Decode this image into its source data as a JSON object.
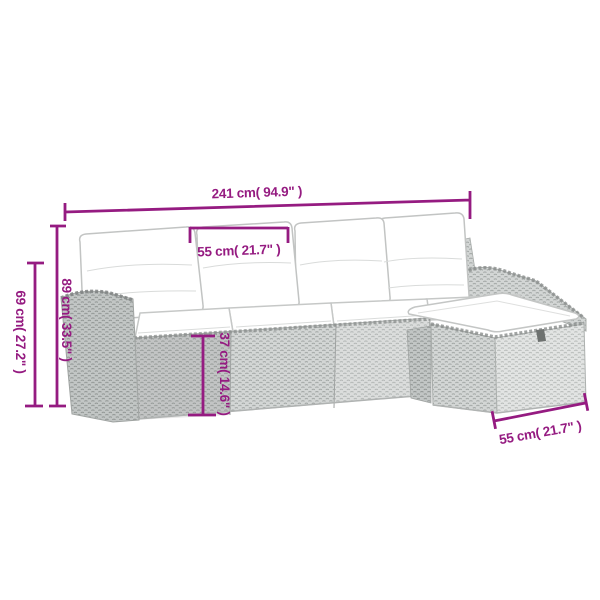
{
  "diagram": {
    "type": "product-dimension-diagram",
    "subject": "rattan lounge set with cushions and ottoman"
  },
  "colors": {
    "accent": "#951b81",
    "line_art": "#c6c8c7",
    "weave_light": "#e2e4e3",
    "weave_mid": "#d3d6d5",
    "weave_dark": "#c2c6c5",
    "cushion_white": "#ffffff",
    "background": "#ffffff"
  },
  "dimensions": {
    "overall_width": "241 cm( 94.9\" )",
    "seat_width": "55 cm( 21.7\" )",
    "back_height": "89 cm( 33.5\" )",
    "arm_height": "69 cm( 27.2\" )",
    "seat_base_height": "37 cm( 14.6\" )",
    "ottoman_depth": "55 cm( 21.7\" )"
  }
}
